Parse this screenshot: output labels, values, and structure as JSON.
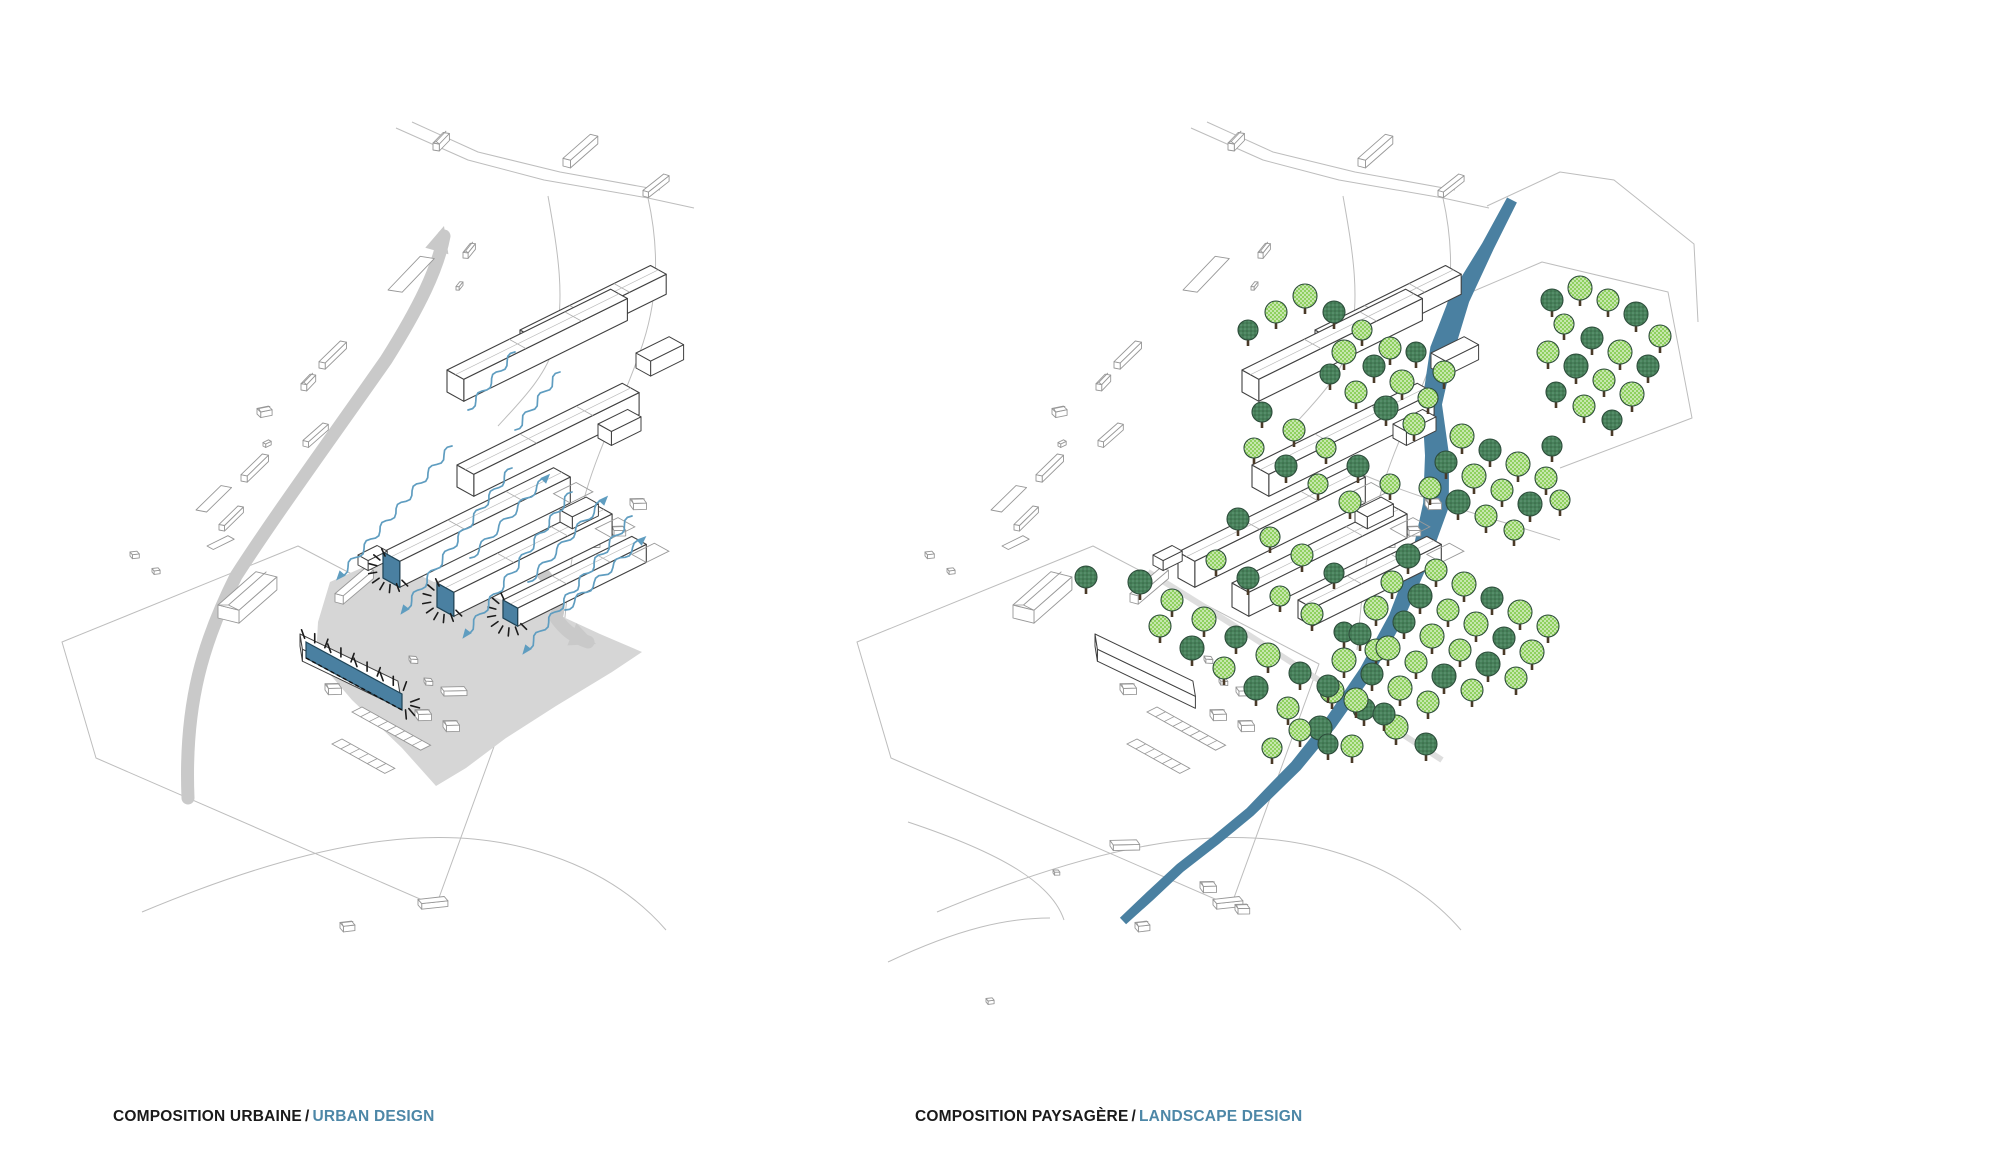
{
  "panels": {
    "left": {
      "caption": {
        "fr": "COMPOSITION URBAINE",
        "sep": "/",
        "en": "URBAN DESIGN"
      }
    },
    "right": {
      "caption": {
        "fr": "COMPOSITION PAYSAGÈRE",
        "sep": "/",
        "en": "LANDSCAPE DESIGN"
      }
    }
  },
  "colors": {
    "accent_blue": "#4a80a1",
    "accent_stroke": "#1f4457",
    "flow_blue": "#5f9dc0",
    "river_blue": "#4a80a1",
    "road_gray": "#c9c9c9",
    "plaza_gray": "#d6d6d6",
    "cluster_stroke": "#404040",
    "context_stroke": "#979797",
    "boundary_gray": "#bdbdbd",
    "tree_light": "#8fd05f",
    "tree_dark": "#47815a",
    "tree_stroke": "#2d4d3b",
    "trunk_brown": "#4a3a28",
    "ray_black": "#1b1b1b"
  },
  "urban": {
    "plaza": "M330,582 L384,558 L404,568 L434,582 L452,576 L474,590 L502,600 L520,596 L548,610 L574,622 L600,634 L642,652 L612,672 L556,706 L506,738 L466,768 L436,786 L402,748 L352,700 L316,658 L318,622 Z",
    "roads": [
      {
        "path": "M188,798 C184,702 204,640 236,576 C276,514 330,440 386,360 C420,306 438,268 444,236",
        "arrow": {
          "x": 444,
          "y": 226,
          "angle": -74
        }
      },
      {
        "path": "M534,564 C556,586 562,600 556,618 C566,632 576,638 588,642",
        "arrow": {
          "x": 596,
          "y": 644,
          "angle": 22
        }
      }
    ],
    "boundaries": [
      "M396,128 L468,160 L544,180 L648,198 L694,208",
      "M412,122 L478,152 L560,172 L660,190",
      "M648,198 C660,252 658,302 640,352 C622,404 600,444 586,492 C572,540 566,602 562,650",
      "M548,196 C558,252 566,300 554,346 C546,376 520,402 498,426",
      "M62,642 L298,546 L524,664 L436,906 L96,758 Z",
      "M142,912 C300,846 430,818 540,852 C600,870 640,900 666,930"
    ],
    "buildings": [
      {
        "x": 520,
        "y": 350,
        "len": 150,
        "wid": 28,
        "hgt": 20,
        "tail": 0
      },
      {
        "x": 447,
        "y": 392,
        "len": 188,
        "wid": 30,
        "hgt": 22,
        "tail": 0
      },
      {
        "x": 457,
        "y": 487,
        "len": 190,
        "wid": 30,
        "hgt": 22,
        "tail": 0
      },
      {
        "x": 383,
        "y": 578,
        "len": 196,
        "wid": 30,
        "hgt": 26,
        "tail": 26
      },
      {
        "x": 437,
        "y": 607,
        "len": 182,
        "wid": 30,
        "hgt": 24,
        "tail": 26
      },
      {
        "x": 503,
        "y": 618,
        "len": 148,
        "wid": 26,
        "hgt": 18,
        "tail": 26
      }
    ],
    "blocks": [
      [
        636,
        368,
        38,
        26,
        15
      ],
      [
        598,
        438,
        34,
        24,
        14
      ],
      [
        560,
        522,
        30,
        22,
        12
      ],
      [
        358,
        565,
        22,
        18,
        10
      ]
    ],
    "facade_bars": [
      3,
      4,
      5
    ],
    "strip": {
      "x1": 306,
      "y1": 642,
      "x2": 402,
      "y2": 694,
      "h": 16
    },
    "flows": [
      [
        452,
        446,
        340,
        576,
        1
      ],
      [
        512,
        468,
        404,
        610,
        1
      ],
      [
        572,
        492,
        466,
        634,
        1
      ],
      [
        632,
        516,
        526,
        650,
        1
      ],
      [
        470,
        558,
        546,
        478,
        1
      ],
      [
        528,
        582,
        604,
        500,
        1
      ],
      [
        565,
        610,
        642,
        540,
        1
      ],
      [
        515,
        352,
        468,
        410,
        0
      ],
      [
        560,
        372,
        515,
        430,
        0
      ]
    ],
    "context": [
      [
        433,
        150,
        "h",
        -20,
        1
      ],
      [
        563,
        166,
        "b",
        -15,
        1.1
      ],
      [
        643,
        196,
        "b",
        -12,
        0.8
      ],
      [
        463,
        258,
        "h",
        -25,
        0.8
      ],
      [
        456,
        290,
        "t",
        -25,
        0.7
      ],
      [
        388,
        290,
        "f",
        -20,
        1.6
      ],
      [
        319,
        368,
        "b",
        -18,
        0.9
      ],
      [
        301,
        390,
        "h",
        -20,
        0.9
      ],
      [
        257,
        414,
        "h",
        15,
        0.8
      ],
      [
        263,
        446,
        "t",
        0,
        0.7
      ],
      [
        303,
        446,
        "b",
        -15,
        0.8
      ],
      [
        241,
        481,
        "b",
        -18,
        0.9
      ],
      [
        196,
        510,
        "f",
        -18,
        1.2
      ],
      [
        219,
        530,
        "b",
        -18,
        0.8
      ],
      [
        207,
        546,
        "f",
        0,
        0.8
      ],
      [
        130,
        556,
        "t",
        20,
        0.8
      ],
      [
        152,
        572,
        "t",
        20,
        0.7
      ],
      [
        218,
        618,
        "s",
        -15,
        1.3
      ],
      [
        335,
        602,
        "b",
        -14,
        1.2
      ],
      [
        409,
        660,
        "t",
        30,
        0.8
      ],
      [
        424,
        682,
        "t",
        30,
        0.8
      ],
      [
        441,
        692,
        "b",
        25,
        0.7
      ],
      [
        415,
        716,
        "h",
        25,
        0.9
      ],
      [
        443,
        727,
        "h",
        25,
        0.9
      ],
      [
        630,
        505,
        "h",
        25,
        0.9
      ],
      [
        611,
        532,
        "h",
        25,
        0.8
      ],
      [
        592,
        545,
        "t",
        25,
        0.7
      ],
      [
        547,
        588,
        "t",
        25,
        0.7
      ],
      [
        527,
        610,
        "t",
        25,
        0.7
      ],
      [
        325,
        690,
        "h",
        25,
        0.9
      ],
      [
        418,
        905,
        "b",
        20,
        0.8
      ],
      [
        340,
        928,
        "h",
        20,
        0.8
      ]
    ]
  },
  "landscape": {
    "dx": 795,
    "river": [
      [
        1512,
        200,
        11
      ],
      [
        1488,
        246,
        13
      ],
      [
        1460,
        298,
        20
      ],
      [
        1442,
        350,
        24
      ],
      [
        1432,
        404,
        20
      ],
      [
        1437,
        455,
        24
      ],
      [
        1436,
        505,
        26
      ],
      [
        1420,
        560,
        18
      ],
      [
        1396,
        618,
        15
      ],
      [
        1366,
        672,
        14
      ],
      [
        1330,
        724,
        13
      ],
      [
        1296,
        766,
        12
      ],
      [
        1268,
        794,
        11
      ],
      [
        1250,
        812,
        10
      ],
      [
        1216,
        840,
        10
      ],
      [
        1180,
        868,
        10
      ],
      [
        1150,
        896,
        10
      ],
      [
        1123,
        921,
        9
      ]
    ],
    "street": "M1148,572 C1240,628 1340,694 1442,760",
    "extra_boundaries": [
      "M1487,206 L1560,172 L1614,180 L1694,244 L1698,322",
      "M1448,302 L1542,262 L1668,292 L1692,418 L1560,468",
      "M1352,470 C1420,500 1500,520 1560,540",
      "M908,822 C1004,854 1052,884 1064,920",
      "M888,962 C960,928 1008,918 1050,918"
    ],
    "extra_context": [
      [
        1200,
        888,
        "h",
        25,
        0.9
      ],
      [
        1235,
        910,
        "h",
        25,
        0.8
      ],
      [
        1053,
        873,
        "t",
        25,
        0.6
      ],
      [
        1110,
        846,
        "b",
        25,
        0.8
      ],
      [
        986,
        1002,
        "t",
        20,
        0.7
      ]
    ],
    "trees": [
      [
        1086,
        577,
        11,
        1
      ],
      [
        1140,
        582,
        12,
        1
      ],
      [
        1172,
        600,
        11,
        0
      ],
      [
        1204,
        619,
        12,
        0
      ],
      [
        1236,
        637,
        11,
        1
      ],
      [
        1268,
        655,
        12,
        0
      ],
      [
        1300,
        673,
        11,
        1
      ],
      [
        1332,
        691,
        12,
        0
      ],
      [
        1364,
        709,
        11,
        1
      ],
      [
        1396,
        727,
        12,
        0
      ],
      [
        1426,
        744,
        11,
        1
      ],
      [
        1160,
        626,
        11,
        0
      ],
      [
        1192,
        648,
        12,
        1
      ],
      [
        1224,
        668,
        11,
        0
      ],
      [
        1256,
        688,
        12,
        1
      ],
      [
        1288,
        708,
        11,
        0
      ],
      [
        1320,
        728,
        12,
        1
      ],
      [
        1352,
        746,
        11,
        0
      ],
      [
        1238,
        519,
        11,
        1
      ],
      [
        1270,
        537,
        10,
        0
      ],
      [
        1302,
        555,
        11,
        0
      ],
      [
        1334,
        573,
        10,
        1
      ],
      [
        1216,
        560,
        10,
        0
      ],
      [
        1248,
        578,
        11,
        1
      ],
      [
        1280,
        596,
        10,
        0
      ],
      [
        1312,
        614,
        11,
        0
      ],
      [
        1344,
        632,
        10,
        1
      ],
      [
        1376,
        650,
        11,
        0
      ],
      [
        1254,
        448,
        10,
        0
      ],
      [
        1286,
        466,
        11,
        1
      ],
      [
        1318,
        484,
        10,
        0
      ],
      [
        1350,
        502,
        11,
        0
      ],
      [
        1262,
        412,
        10,
        1
      ],
      [
        1294,
        430,
        11,
        0
      ],
      [
        1326,
        448,
        10,
        0
      ],
      [
        1358,
        466,
        11,
        1
      ],
      [
        1390,
        484,
        10,
        0
      ],
      [
        1276,
        312,
        11,
        0
      ],
      [
        1305,
        296,
        12,
        0
      ],
      [
        1334,
        312,
        11,
        1
      ],
      [
        1362,
        330,
        10,
        0
      ],
      [
        1390,
        348,
        11,
        0
      ],
      [
        1248,
        330,
        10,
        1
      ],
      [
        1344,
        352,
        12,
        0
      ],
      [
        1374,
        366,
        11,
        1
      ],
      [
        1402,
        382,
        12,
        0
      ],
      [
        1356,
        392,
        11,
        0
      ],
      [
        1386,
        408,
        12,
        1
      ],
      [
        1414,
        424,
        11,
        0
      ],
      [
        1330,
        374,
        10,
        1
      ],
      [
        1428,
        398,
        10,
        0
      ],
      [
        1416,
        352,
        10,
        1
      ],
      [
        1444,
        372,
        11,
        0
      ],
      [
        1552,
        300,
        11,
        1
      ],
      [
        1580,
        288,
        12,
        0
      ],
      [
        1608,
        300,
        11,
        0
      ],
      [
        1636,
        314,
        12,
        1
      ],
      [
        1660,
        336,
        11,
        0
      ],
      [
        1564,
        324,
        10,
        0
      ],
      [
        1592,
        338,
        11,
        1
      ],
      [
        1620,
        352,
        12,
        0
      ],
      [
        1648,
        366,
        11,
        1
      ],
      [
        1548,
        352,
        11,
        0
      ],
      [
        1576,
        366,
        12,
        1
      ],
      [
        1604,
        380,
        11,
        0
      ],
      [
        1632,
        394,
        12,
        0
      ],
      [
        1556,
        392,
        10,
        1
      ],
      [
        1584,
        406,
        11,
        0
      ],
      [
        1612,
        420,
        10,
        1
      ],
      [
        1462,
        436,
        12,
        0
      ],
      [
        1490,
        450,
        11,
        1
      ],
      [
        1518,
        464,
        12,
        0
      ],
      [
        1546,
        478,
        11,
        0
      ],
      [
        1446,
        462,
        11,
        1
      ],
      [
        1474,
        476,
        12,
        0
      ],
      [
        1502,
        490,
        11,
        0
      ],
      [
        1530,
        504,
        12,
        1
      ],
      [
        1430,
        488,
        11,
        0
      ],
      [
        1458,
        502,
        12,
        1
      ],
      [
        1486,
        516,
        11,
        0
      ],
      [
        1514,
        530,
        10,
        0
      ],
      [
        1552,
        446,
        10,
        1
      ],
      [
        1560,
        500,
        10,
        0
      ],
      [
        1408,
        556,
        12,
        1
      ],
      [
        1436,
        570,
        11,
        0
      ],
      [
        1464,
        584,
        12,
        0
      ],
      [
        1492,
        598,
        11,
        1
      ],
      [
        1520,
        612,
        12,
        0
      ],
      [
        1548,
        626,
        11,
        0
      ],
      [
        1392,
        582,
        11,
        0
      ],
      [
        1420,
        596,
        12,
        1
      ],
      [
        1448,
        610,
        11,
        0
      ],
      [
        1476,
        624,
        12,
        0
      ],
      [
        1504,
        638,
        11,
        1
      ],
      [
        1532,
        652,
        12,
        0
      ],
      [
        1376,
        608,
        12,
        0
      ],
      [
        1404,
        622,
        11,
        1
      ],
      [
        1432,
        636,
        12,
        0
      ],
      [
        1460,
        650,
        11,
        0
      ],
      [
        1488,
        664,
        12,
        1
      ],
      [
        1516,
        678,
        11,
        0
      ],
      [
        1360,
        634,
        11,
        1
      ],
      [
        1388,
        648,
        12,
        0
      ],
      [
        1416,
        662,
        11,
        0
      ],
      [
        1444,
        676,
        12,
        1
      ],
      [
        1472,
        690,
        11,
        0
      ],
      [
        1344,
        660,
        12,
        0
      ],
      [
        1372,
        674,
        11,
        1
      ],
      [
        1400,
        688,
        12,
        0
      ],
      [
        1428,
        702,
        11,
        0
      ],
      [
        1328,
        686,
        11,
        1
      ],
      [
        1356,
        700,
        12,
        0
      ],
      [
        1384,
        714,
        11,
        1
      ],
      [
        1300,
        730,
        11,
        0
      ],
      [
        1328,
        744,
        10,
        1
      ],
      [
        1272,
        748,
        10,
        0
      ]
    ]
  }
}
